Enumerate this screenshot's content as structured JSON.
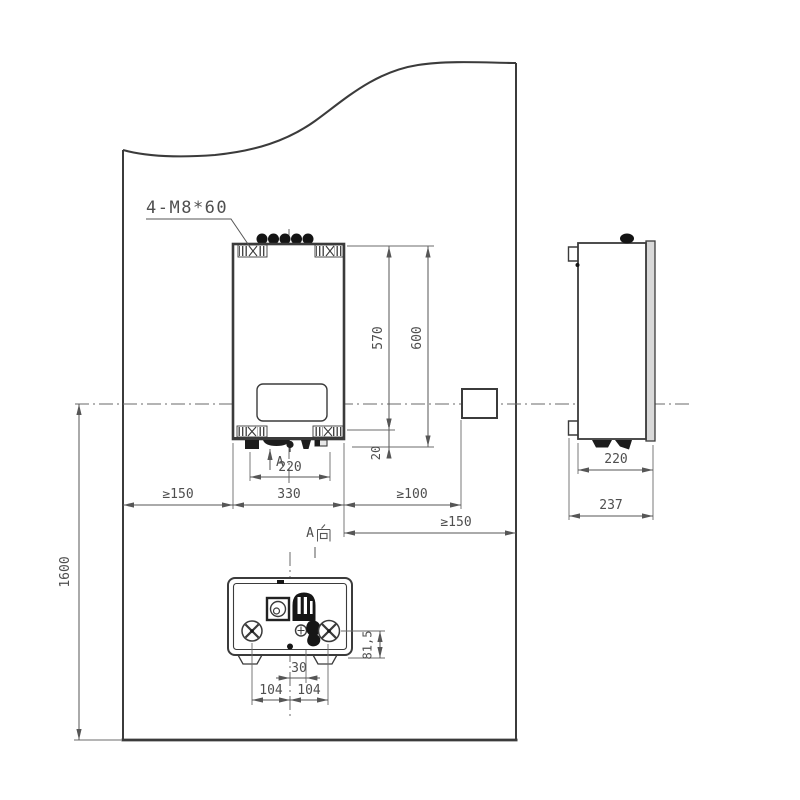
{
  "colors": {
    "background": "#ffffff",
    "drawing_line": "#3b3b3b",
    "dimension_line": "#565656",
    "text": "#4f4f4f"
  },
  "labels": {
    "mounting_bolts": "4-M8*60",
    "section_arrow": "A",
    "section_view": "A向",
    "section_view_latin": "A"
  },
  "front_view": {
    "width": "330",
    "height_total": "600",
    "height_to_bracket": "570",
    "bracket_bottom_offset": "20",
    "connector_spacing": "220"
  },
  "clearances": {
    "left_min": "≥150",
    "outlet_min": "≥100",
    "right_min": "≥150",
    "mount_height": "1600"
  },
  "side_view": {
    "body_depth": "220",
    "total_depth": "237"
  },
  "bottom_view": {
    "gas_offset": "30",
    "pitch_left": "104",
    "pitch_right": "104",
    "port_height": "81,5"
  }
}
